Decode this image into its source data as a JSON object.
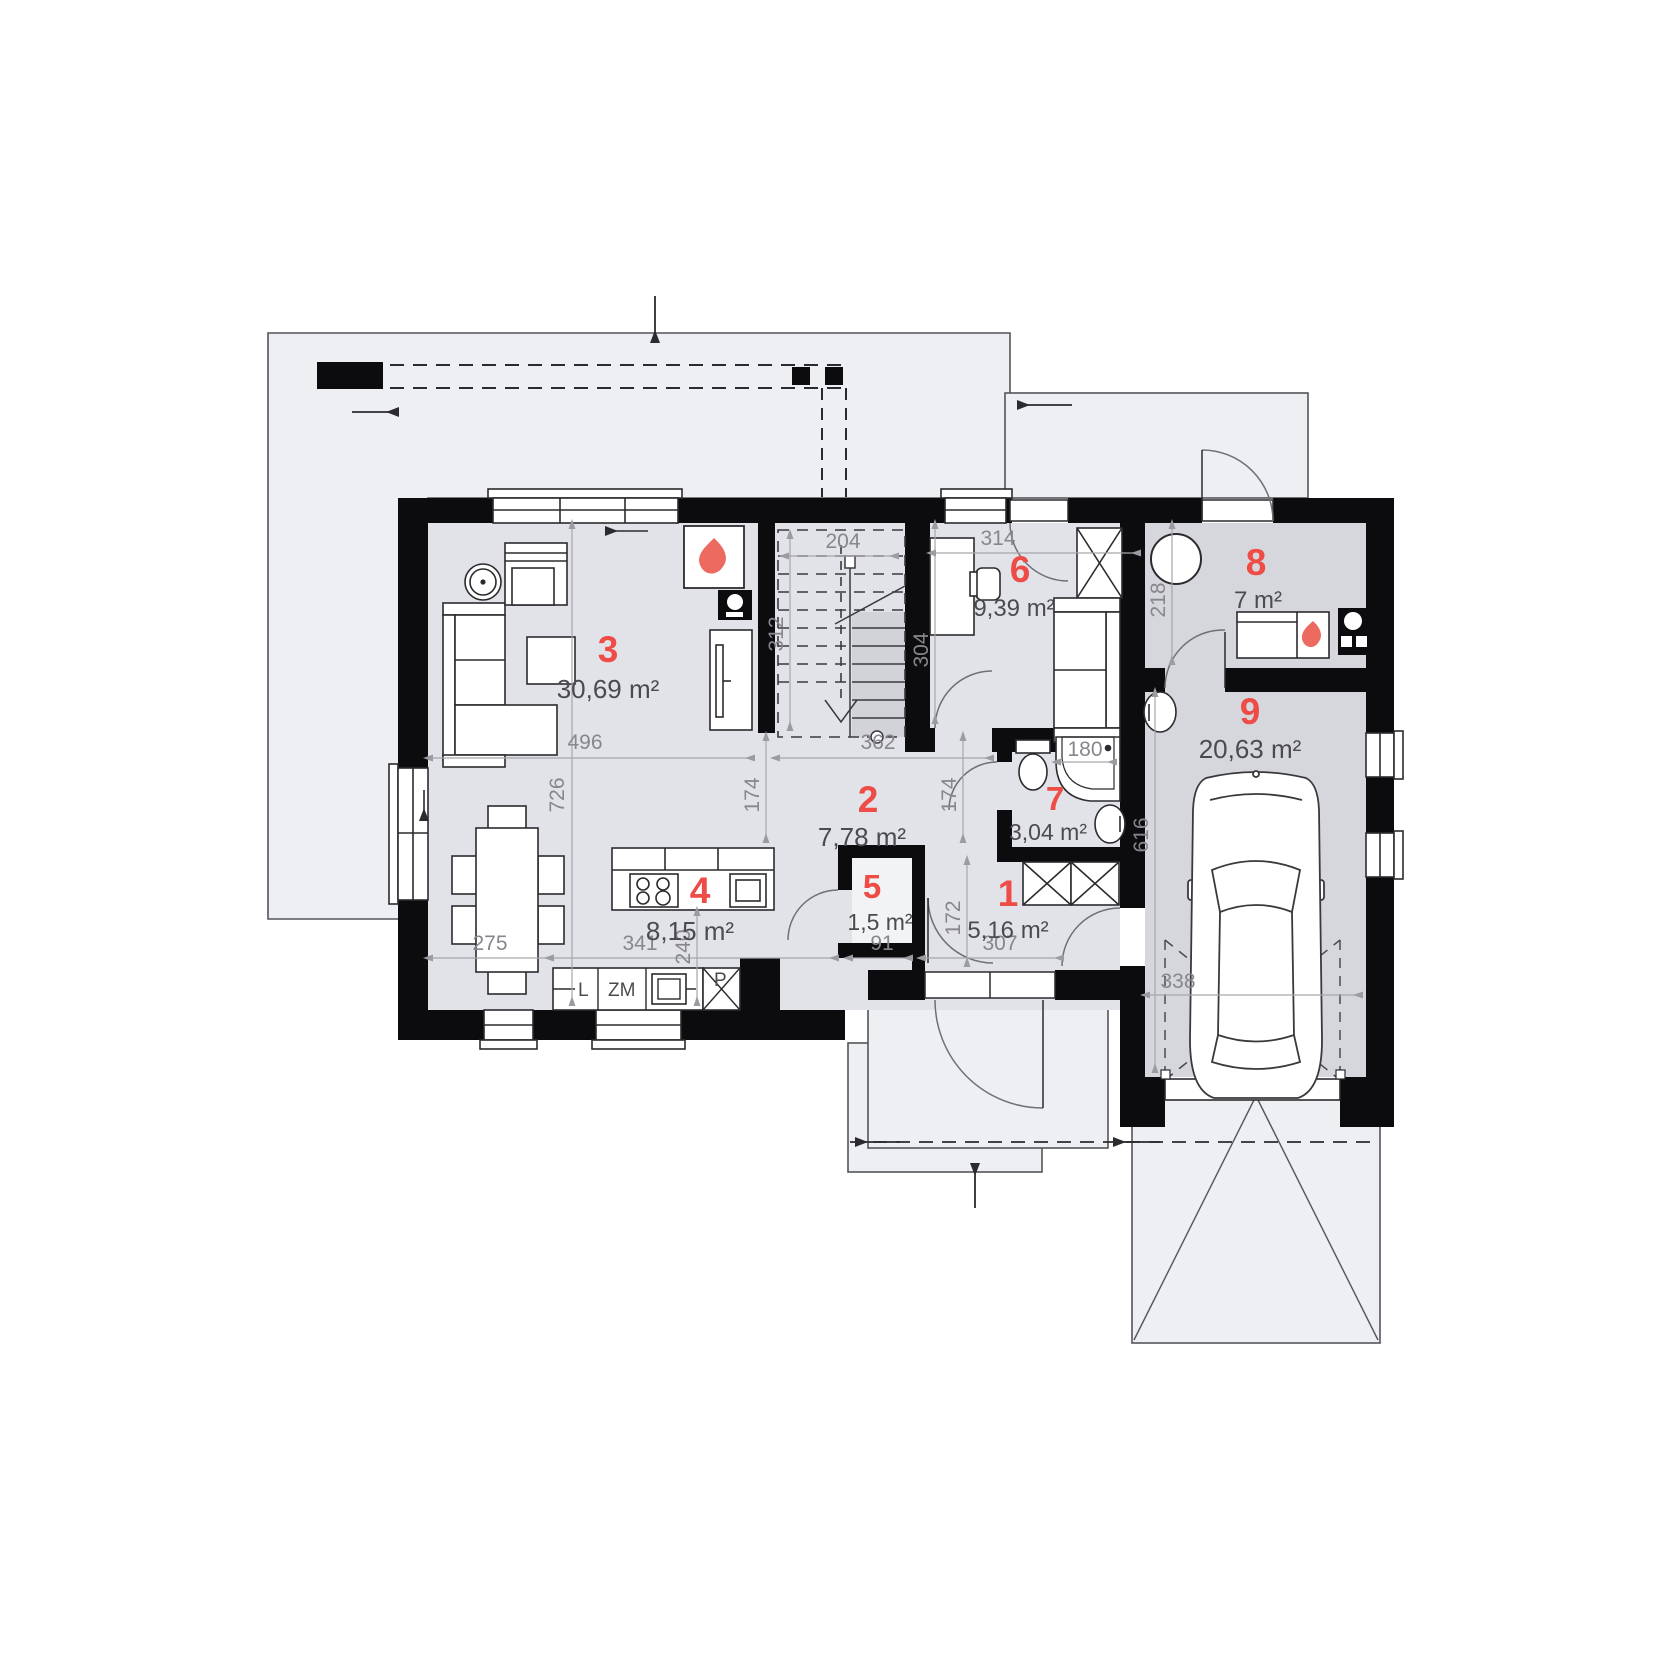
{
  "title": "House ground floor plan",
  "colors": {
    "wall": "#0c0c0e",
    "floor_light": "#e2e3e8",
    "floor_dark": "#d6d7dc",
    "outside": "#edeff3",
    "accent_red": "#ee4c46",
    "dim_gray": "#9b9ba1"
  },
  "rooms": [
    {
      "number": "1",
      "area": "5,16 m²"
    },
    {
      "number": "2",
      "area": "7,78 m²"
    },
    {
      "number": "3",
      "area": "30,69 m²"
    },
    {
      "number": "4",
      "area": "8,15 m²"
    },
    {
      "number": "5",
      "area": "1,5 m²"
    },
    {
      "number": "6",
      "area": "9,39 m²"
    },
    {
      "number": "7",
      "area": "3,04 m²"
    },
    {
      "number": "8",
      "area": "7 m²"
    },
    {
      "number": "9",
      "area": "20,63 m²"
    }
  ],
  "dimensions": {
    "stairs_width": "204",
    "stairs_depth": "312",
    "room6_width": "314",
    "room6_depth": "304",
    "room8_depth": "218",
    "living_width": "496",
    "corridor_width": "362",
    "living_depth": "726",
    "corridor_a": "174",
    "corridor_b": "174",
    "hall_depth": "172",
    "shower": "180",
    "garage_depth": "616",
    "garage_width": "338",
    "dining_width": "275",
    "kitchen_width": "341",
    "island_len": "240",
    "pantry_width": "91",
    "hall_width": "307"
  },
  "appliances": {
    "fridge": "L",
    "dishwasher": "ZM",
    "washing_machine": "P"
  }
}
